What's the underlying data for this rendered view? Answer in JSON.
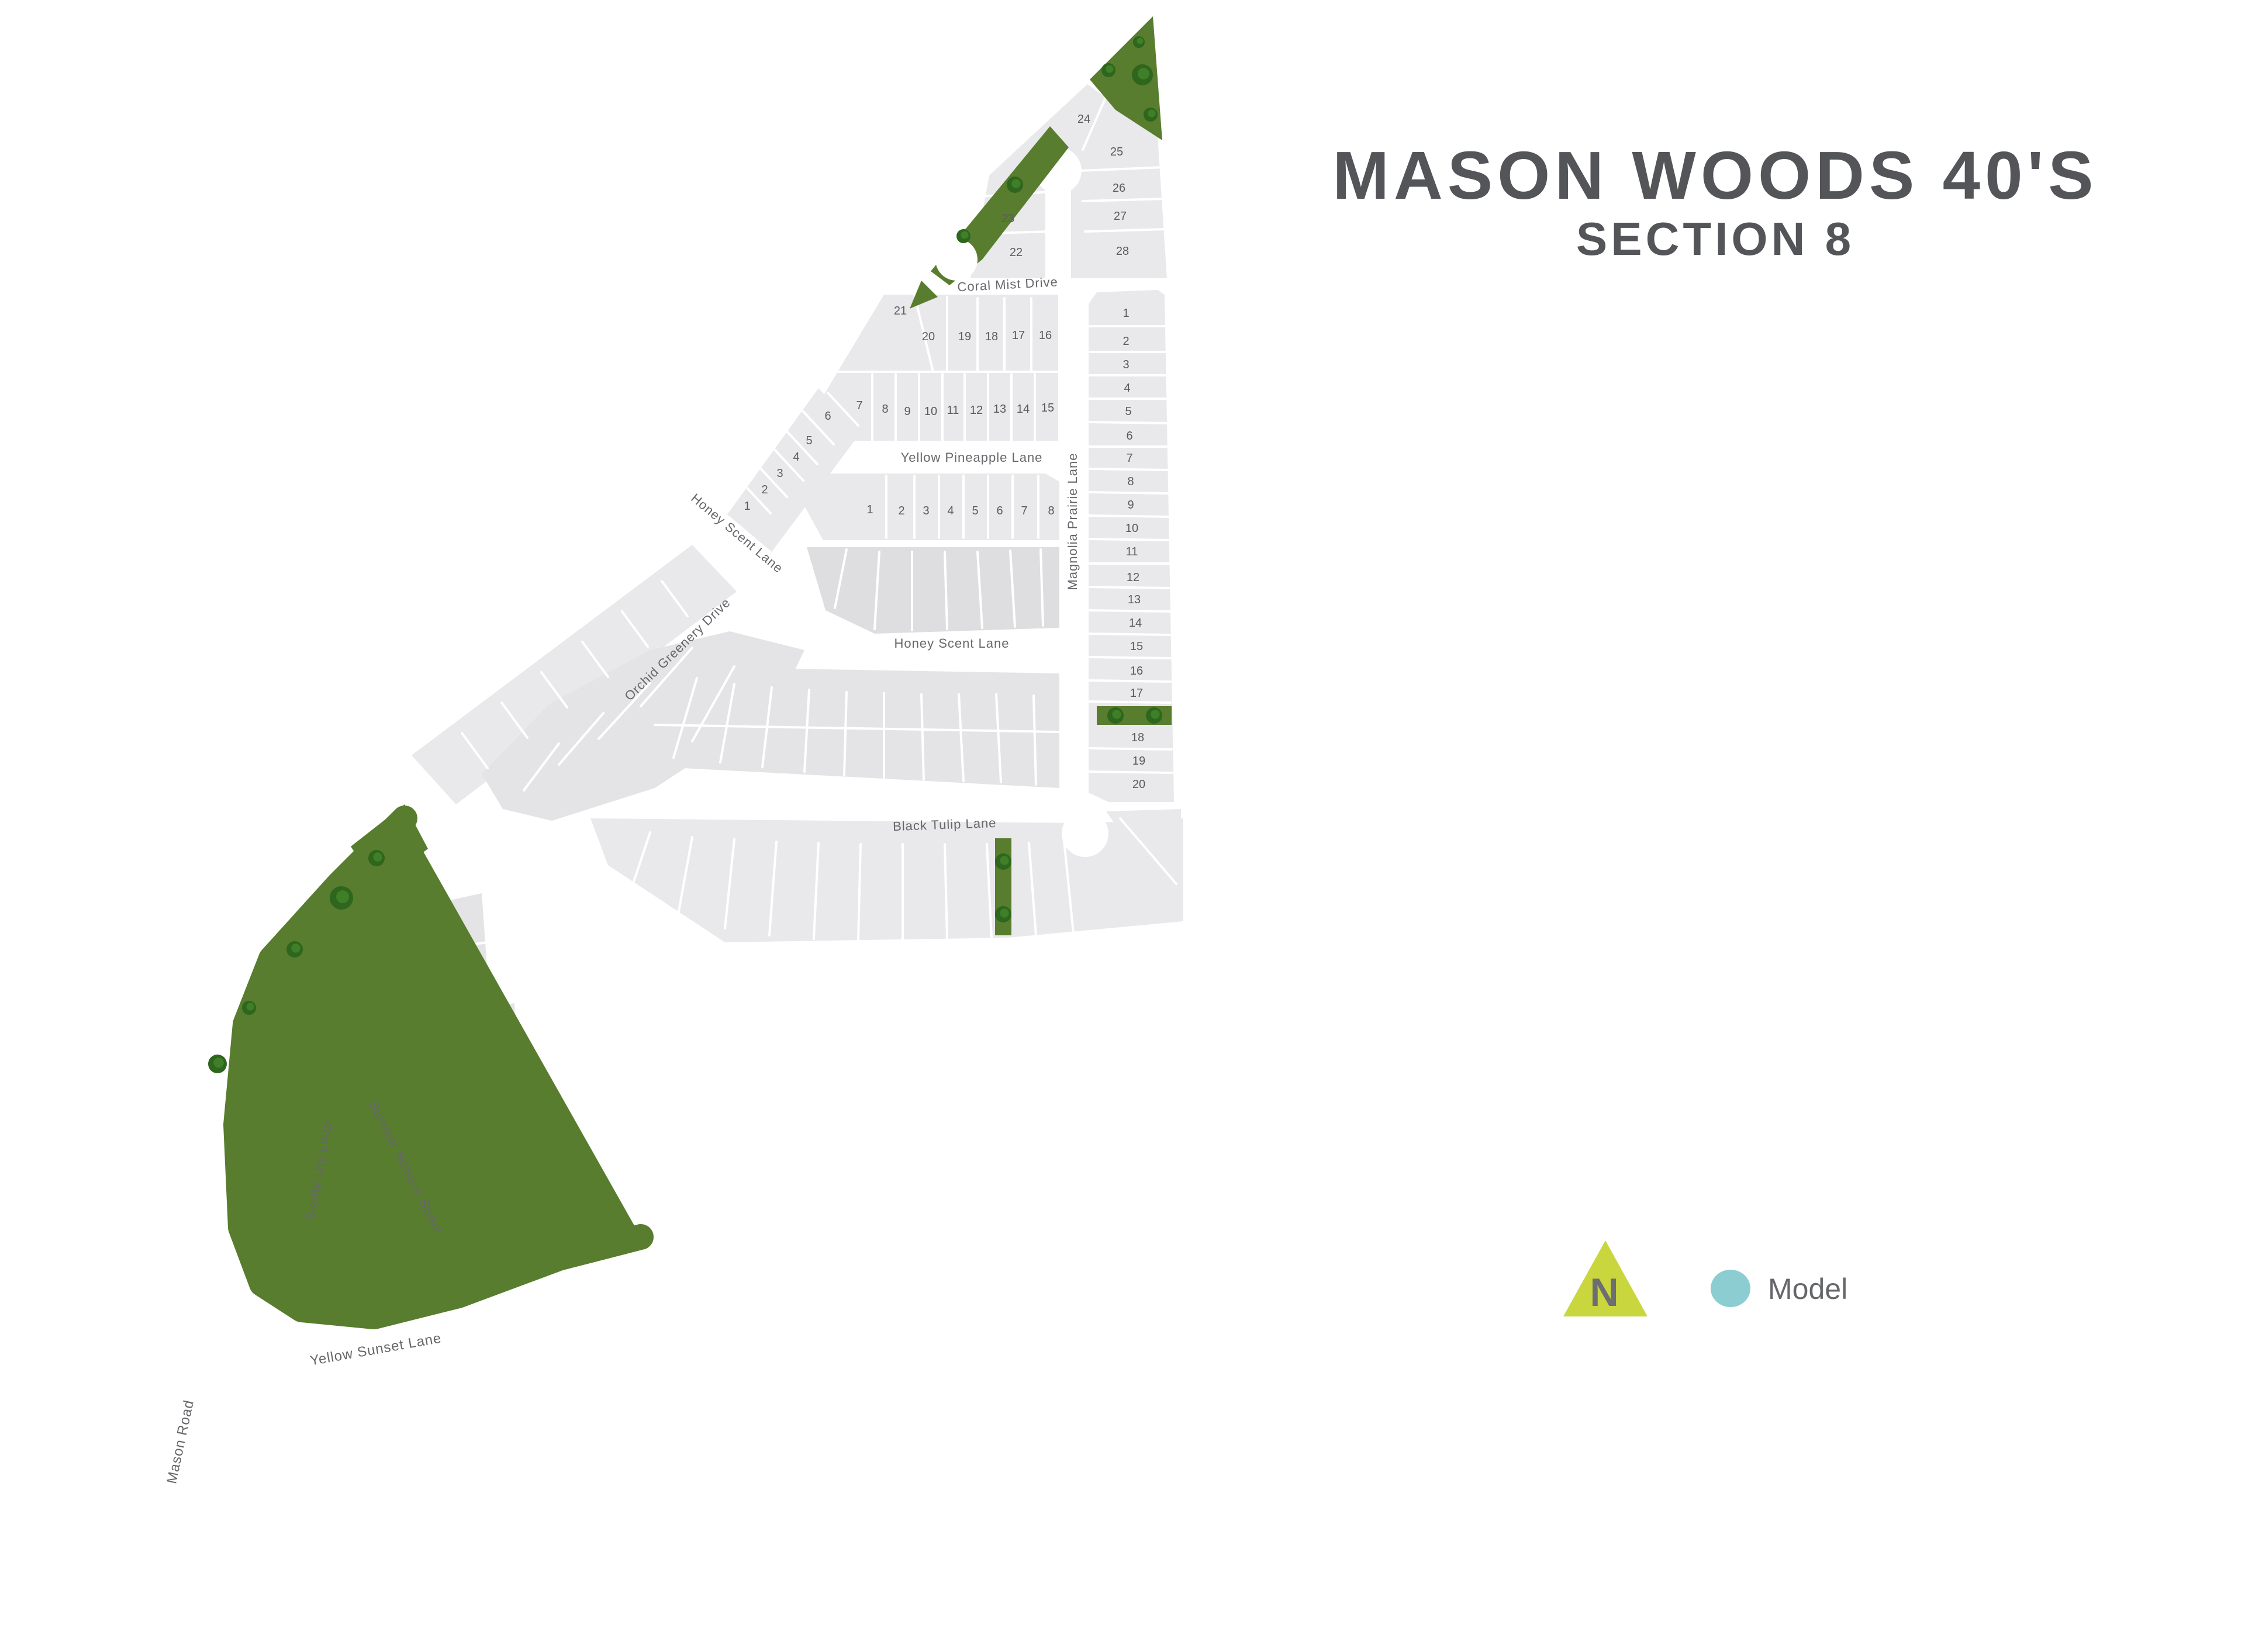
{
  "title": {
    "line1": "MASON WOODS 40'S",
    "line2": "SECTION 8"
  },
  "legend": {
    "north_label": "N",
    "model_label": "Model"
  },
  "streets": {
    "coral_mist": "Coral Mist Drive",
    "yellow_pineapple": "Yellow Pineapple Lane",
    "honey_scent_upper": "Honey Scent Lane",
    "honey_scent_middle": "Honey Scent Lane",
    "magnolia": "Magnolia Prairie Lane",
    "black_tulip": "Black Tulip Lane",
    "orchid": "Orchid Greenery Drive",
    "sunny_lily": "Sunny Lily Loop",
    "summer_solstice": "Summer Solstice Street",
    "yellow_sunset": "Yellow Sunset Lane",
    "mason_road": "Mason Road"
  },
  "lots": {
    "top_cluster": [
      "22",
      "23",
      "24",
      "25",
      "26",
      "27",
      "28"
    ],
    "north_row": [
      "21",
      "20",
      "19",
      "18",
      "17",
      "16"
    ],
    "mid_row": [
      "7",
      "8",
      "9",
      "10",
      "11",
      "12",
      "13",
      "14",
      "15"
    ],
    "west_diagonal": [
      "1",
      "2",
      "3",
      "4",
      "5",
      "6"
    ],
    "pineapple_row": [
      "1",
      "2",
      "3",
      "4",
      "5",
      "6",
      "7",
      "8"
    ],
    "east_column": [
      "1",
      "2",
      "3",
      "4",
      "5",
      "6",
      "7",
      "8",
      "9",
      "10",
      "11",
      "12",
      "13",
      "14",
      "15",
      "16",
      "17",
      "18",
      "19",
      "20"
    ]
  },
  "colors": {
    "background": "#ffffff",
    "lot_fill": "#e9e9eb",
    "lot_fill_medium": "#e4e4e6",
    "lot_fill_dark": "#dedee0",
    "lot_fill_soft": "#e6e6e8",
    "greenbelt": "#587d2e",
    "tree_dark": "#2d661c",
    "tree_light": "#3f7f28",
    "title_text": "#545559",
    "label_text": "#66676a",
    "lot_number_text": "#5a5b5e",
    "north_arrow": "#c9d63e",
    "north_letter": "#6d6e71",
    "model_marker": "#8ccdd1"
  }
}
